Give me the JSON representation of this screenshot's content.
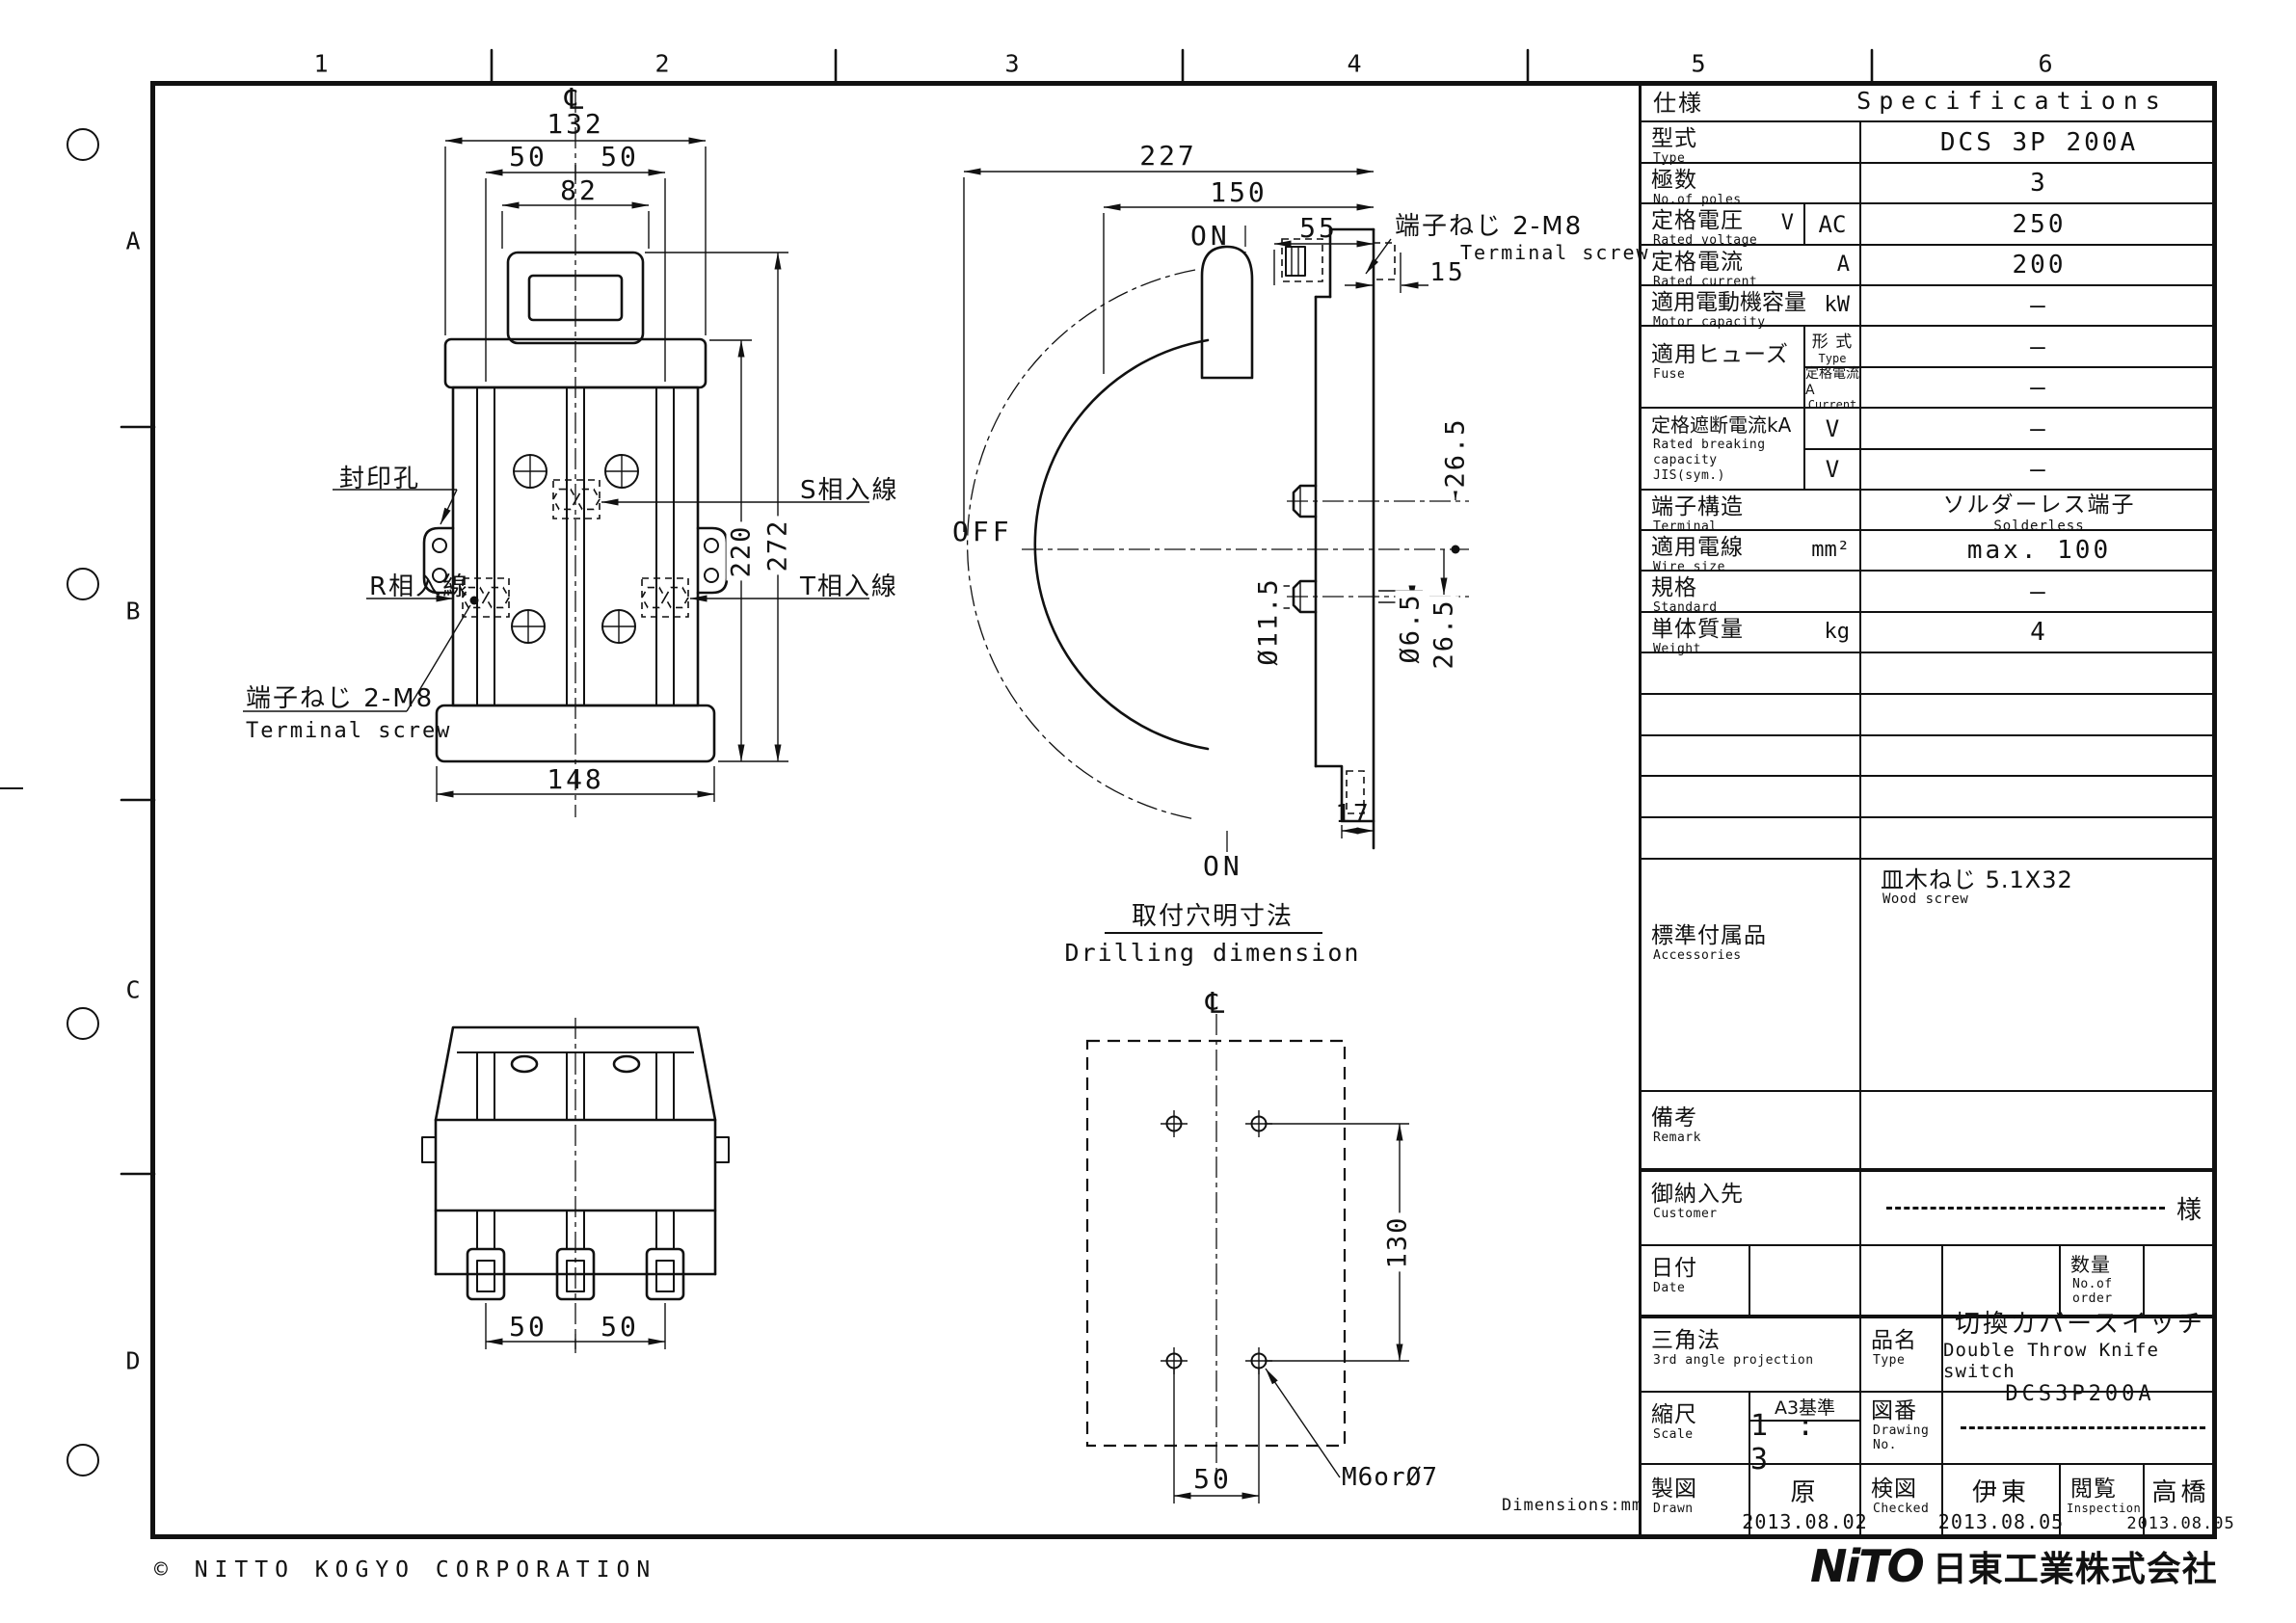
{
  "sheet": {
    "grid_cols": [
      "1",
      "2",
      "3",
      "4",
      "5",
      "6"
    ],
    "grid_rows": [
      "A",
      "B",
      "C",
      "D"
    ],
    "copyright": "© NITTO KOGYO CORPORATION",
    "logo_mark": "NiTO",
    "logo_company": "日東工業株式会社",
    "dimensions_note": "Dimensions:mm"
  },
  "front": {
    "cl": "℄",
    "d132": "132",
    "d50a": "50",
    "d50b": "50",
    "d82": "82",
    "d220": "220",
    "d272": "272",
    "d148": "148",
    "seal": "封印孔",
    "r": "R相入線",
    "s": "S相入線",
    "t": "T相入線",
    "term_jp": "端子ねじ 2-M8",
    "term_en": "Terminal screw"
  },
  "side": {
    "d227": "227",
    "d150": "150",
    "d55": "55",
    "d15": "15",
    "term_jp": "端子ねじ 2-M8",
    "term_en": "Terminal screw",
    "on_top": "ON",
    "off": "OFF",
    "on_bottom": "ON",
    "d265a": "26.5",
    "d115": "Ø11.5",
    "d65": "Ø6.5",
    "d265b": "26.5",
    "d17": "17"
  },
  "bottomview": {
    "d50a": "50",
    "d50b": "50"
  },
  "drill": {
    "title_jp": "取付穴明寸法",
    "title_en": "Drilling dimension",
    "cl": "℄",
    "d130": "130",
    "d50": "50",
    "hole": "M6orØ7"
  },
  "spec": {
    "header_jp": "仕様",
    "header_en": "Specifications",
    "type": {
      "jp": "型式",
      "en": "Type",
      "value": "DCS 3P 200A"
    },
    "poles": {
      "jp": "極数",
      "en": "No.of poles",
      "value": "3"
    },
    "voltage": {
      "jp": "定格電圧",
      "unit": "V",
      "en": "Rated voltage",
      "sub": "AC",
      "value": "250"
    },
    "current": {
      "jp": "定格電流",
      "unit": "A",
      "en": "Rated current",
      "value": "200"
    },
    "motor": {
      "jp": "適用電動機容量",
      "unit": "kW",
      "en": "Motor capacity",
      "value": "—"
    },
    "fuse": {
      "jp": "適用ヒューズ",
      "en": "Fuse",
      "type_jp": "形 式",
      "type_en": "Type",
      "type_value": "—",
      "cur_jp": "定格電流A",
      "cur_en": "Current",
      "cur_value": "—"
    },
    "breaking": {
      "jp": "定格遮断電流kA",
      "en1": "Rated breaking",
      "en2": "capacity",
      "en3": "JIS(sym.)",
      "sub1": "V",
      "value1": "—",
      "sub2": "V",
      "value2": "—"
    },
    "terminal": {
      "jp": "端子構造",
      "en": "Terminal",
      "value_jp": "ソルダーレス端子",
      "value_en": "Solderless"
    },
    "wire": {
      "jp": "適用電線",
      "unit": "mm²",
      "en": "Wire size",
      "value": "max. 100"
    },
    "standard": {
      "jp": "規格",
      "en": "Standard",
      "value": "—"
    },
    "weight": {
      "jp": "単体質量",
      "unit": "kg",
      "en": "Weight",
      "value": "4"
    },
    "accessories": {
      "jp": "標準付属品",
      "en": "Accessories",
      "value_jp": "皿木ねじ 5.1X32",
      "value_en": "Wood screw"
    },
    "remark": {
      "jp": "備考",
      "en": "Remark"
    }
  },
  "title_block": {
    "customer": {
      "jp": "御納入先",
      "en": "Customer",
      "suffix": "様"
    },
    "date": {
      "jp": "日付",
      "en": "Date"
    },
    "qty": {
      "jp": "数量",
      "en1": "No.of",
      "en2": "order"
    },
    "projection": {
      "jp": "三角法",
      "en": "3rd angle projection"
    },
    "name": {
      "jp": "品名",
      "en": "Type",
      "value_jp": "切換カバースイッチ",
      "value_en": "Double Throw Knife switch",
      "value_model": "DCS3P200A"
    },
    "scale": {
      "jp": "縮尺",
      "en": "Scale",
      "std": "A3基準",
      "value": "1 : 3"
    },
    "dno": {
      "jp": "図番",
      "en1": "Drawing",
      "en2": "No."
    },
    "drawn": {
      "jp": "製図",
      "en": "Drawn",
      "name": "原",
      "date": "2013.08.02"
    },
    "checked": {
      "jp": "検図",
      "en": "Checked",
      "name": "伊東",
      "date": "2013.08.05"
    },
    "inspection": {
      "jp": "閲覧",
      "en": "Inspection",
      "name": "高橋",
      "date": "2013.08.05"
    }
  }
}
